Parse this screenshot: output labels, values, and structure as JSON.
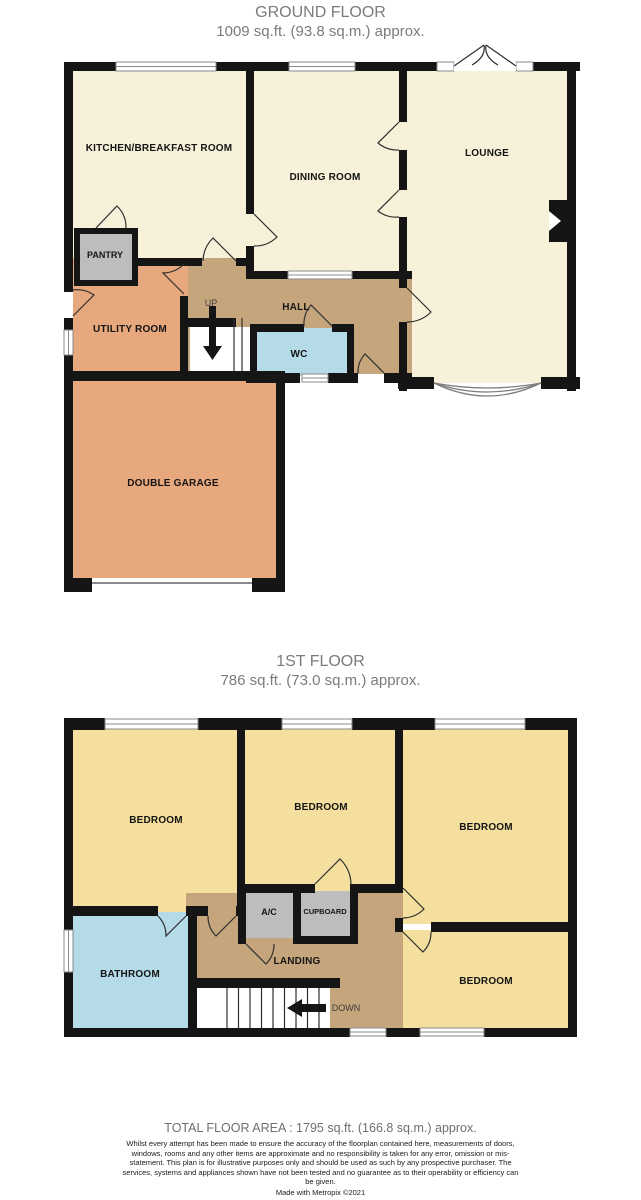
{
  "ground_floor": {
    "title": "GROUND FLOOR",
    "area_label": "1009 sq.ft. (93.8 sq.m.) approx.",
    "rooms": {
      "kitchen": "KITCHEN/BREAKFAST ROOM",
      "dining": "DINING ROOM",
      "lounge": "LOUNGE",
      "pantry": "PANTRY",
      "utility": "UTILITY ROOM",
      "hall": "HALL",
      "wc": "WC",
      "garage": "DOUBLE GARAGE"
    },
    "stairs_label": "UP"
  },
  "first_floor": {
    "title": "1ST FLOOR",
    "area_label": "786 sq.ft. (73.0 sq.m.) approx.",
    "rooms": {
      "bedroom": "BEDROOM",
      "bathroom": "BATHROOM",
      "landing": "LANDING",
      "ac": "A/C",
      "cupboard": "CUPBOARD"
    },
    "stairs_label": "DOWN"
  },
  "footer": {
    "total_area": "TOTAL FLOOR AREA : 1795 sq.ft. (166.8 sq.m.) approx.",
    "disclaimer": "Whilst every attempt has been made to ensure the accuracy of the floorplan contained here, measurements of doors, windows, rooms and any other items are approximate and no responsibility is taken for any error, omission or mis-statement. This plan is for illustrative purposes only and should be used as such by any prospective purchaser. The services, systems and appliances shown have not been tested and no guarantee as to their operability or efficiency can be given.",
    "credit": "Made with Metropix ©2021"
  },
  "colors": {
    "wall": "#151515",
    "cream_room": "#F7F1DA",
    "yellow_room": "#F5DF9F",
    "orange_room": "#E8A87D",
    "tan_room": "#C5A67C",
    "gray_room": "#BDBDBD",
    "blue_room": "#B4DBE7"
  }
}
